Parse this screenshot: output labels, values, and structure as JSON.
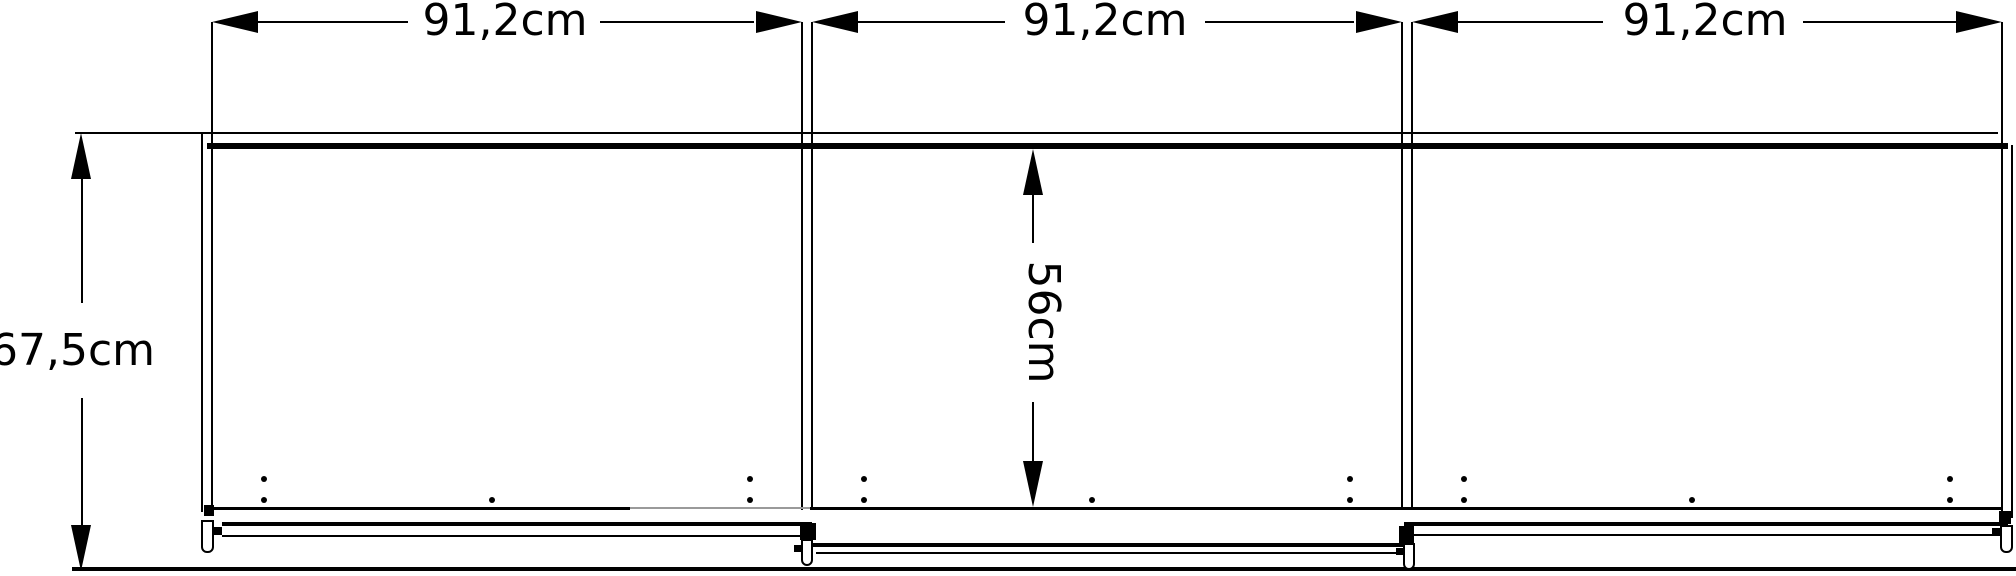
{
  "dimensions": {
    "section_widths": [
      {
        "label": "91,2cm"
      },
      {
        "label": "91,2cm"
      },
      {
        "label": "91,2cm"
      }
    ],
    "overall_height": {
      "label": "67,5cm"
    },
    "interior_height": {
      "label": "56cm"
    }
  },
  "colors": {
    "line": "#000000",
    "muted_line": "#9a9a9a",
    "background": "#ffffff"
  }
}
